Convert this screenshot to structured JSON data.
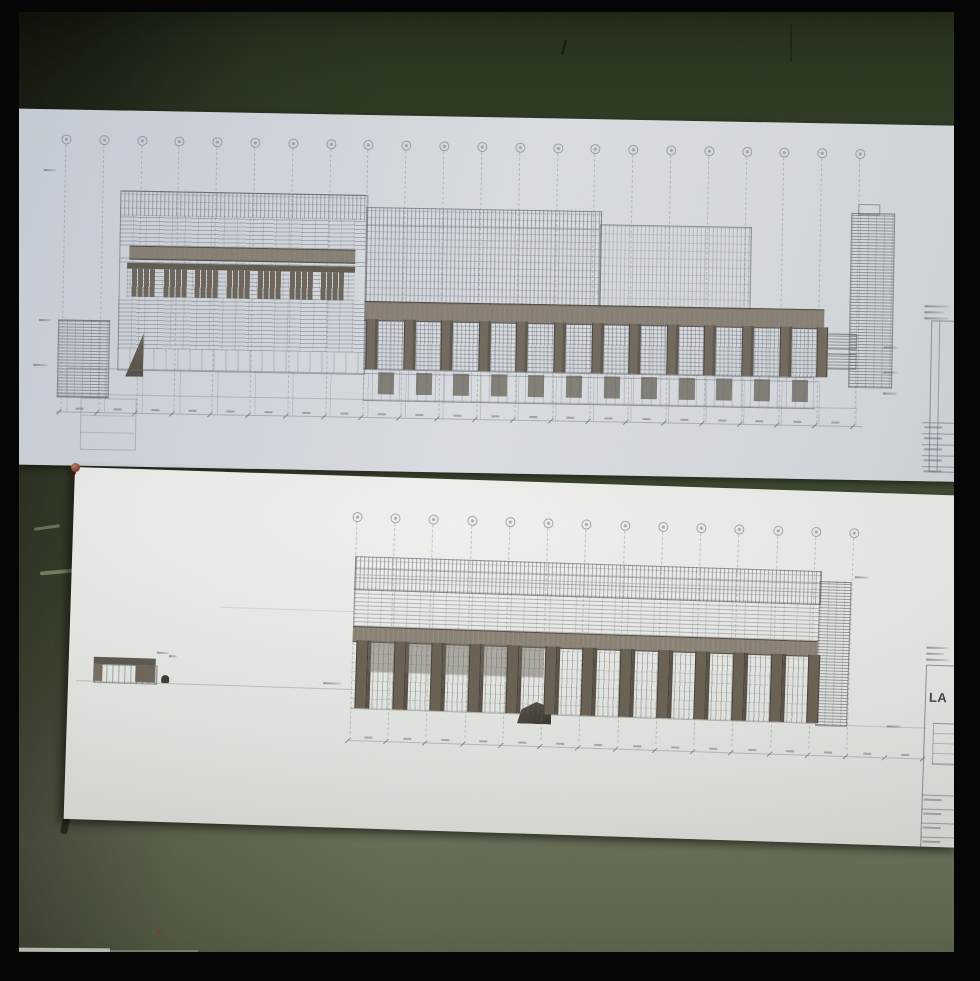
{
  "scene": {
    "type": "35mm slide photograph",
    "subject": "Two architectural elevation drawings of a long building pinned to a dark green wall",
    "film_border_color": "#050505",
    "wall_colors": {
      "top_band": "#2c3722",
      "mid_strip": "#3a452d",
      "bottom_band": "#5e6750"
    },
    "marks": {
      "red_speck_color": "#7c3a28",
      "scratch_color": "#828a66",
      "pushpin_color": "#8a4a38"
    }
  },
  "upper_sheet": {
    "paper_tint": "bluish gray",
    "drawing_kind": "long street elevation with stepped massing, window bands and colonnade",
    "title_block": {
      "position": "right edge, cropped by frame",
      "text_legible": false
    },
    "labels_legible": false
  },
  "lower_sheet": {
    "paper_tint": "warm white",
    "drawing_kind": "long elevation with pier colonnade, brick end bay and small gatehouse at left",
    "title_block": {
      "visible_text_fragment": "LA",
      "other_text_legible": false
    },
    "labels_legible": false
  },
  "render": {
    "upper": {
      "bubbles": {
        "count": 22,
        "x0": 78,
        "x1": 872,
        "y": 29,
        "r": 4,
        "line_bottom": 300
      },
      "windows": {
        "count": 7,
        "x0": 146,
        "step": 31.5,
        "w": 24,
        "y": 158,
        "h": 28
      },
      "piers": {
        "count": 13,
        "x0": 382,
        "step": 37.6,
        "w": 9,
        "y": 204,
        "h": 50
      },
      "doors": {
        "count": 12,
        "x0": 395,
        "step": 37.6,
        "w": 16,
        "y": 257,
        "h": 22
      },
      "ticks": {
        "count": 22,
        "x0": 78,
        "x1": 872,
        "y": 302
      },
      "smudges": [
        [
          57,
          60,
          12
        ],
        [
          55,
          210,
          12
        ],
        [
          50,
          255,
          14
        ],
        [
          900,
          222,
          14
        ],
        [
          900,
          247,
          14
        ],
        [
          900,
          268,
          14
        ],
        [
          940,
          180,
          24
        ],
        [
          940,
          186,
          20
        ],
        [
          940,
          192,
          24
        ]
      ],
      "tb_rows": [
        297,
        308,
        319,
        330,
        341
      ]
    },
    "lower": {
      "bubbles": {
        "count": 14,
        "x0": 283,
        "x1": 780,
        "y": 40,
        "r": 4,
        "line_bottom": 258
      },
      "piers": {
        "count": 13,
        "x0": 287,
        "step": 37.7,
        "w": 10,
        "y": 164,
        "h": 68
      },
      "ticks": {
        "count": 16,
        "x0": 283,
        "x1": 858,
        "y": 264
      },
      "smudges": [
        [
          88,
          182,
          12
        ],
        [
          100,
          185,
          8
        ],
        [
          255,
          207,
          18
        ],
        [
          783,
          84,
          14
        ],
        [
          820,
          232,
          14
        ],
        [
          857,
          152,
          22
        ],
        [
          857,
          158,
          18
        ],
        [
          857,
          164,
          22
        ]
      ],
      "tb_rows": [
        300,
        314,
        328,
        342,
        356,
        370
      ]
    }
  }
}
